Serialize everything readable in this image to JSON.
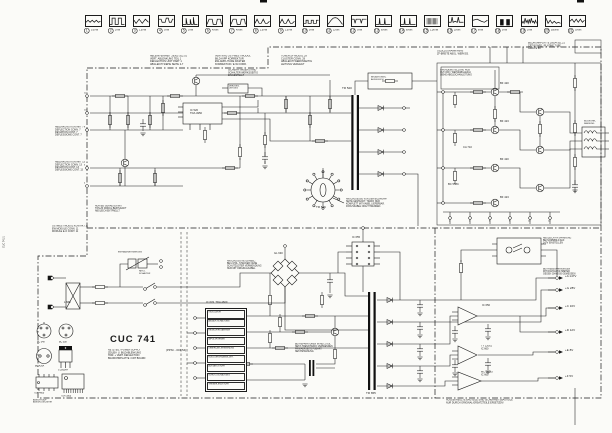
{
  "title_block": {
    "title": "CUC 741",
    "subtitle_lines": [
      "NETZTEIL / POWER SUPPLY",
      "ZEILEN- U. BILDABLENKUNG",
      "HOR. + VERT. DEFLECTION",
      "BILDROHRPLATTE / CRT BOARD"
    ],
    "part_number": "(PPNr - 001.54)"
  },
  "waveforms": [
    {
      "n": "1",
      "v": "0,3Vss",
      "shape": "sine-low"
    },
    {
      "n": "2",
      "v": "2Vss",
      "shape": "pulse2"
    },
    {
      "n": "3",
      "v": "1,5Vss",
      "shape": "sine-inv"
    },
    {
      "n": "4",
      "v": "3Vss",
      "shape": "mesa"
    },
    {
      "n": "5",
      "v": "2Vss",
      "shape": "spike-bar"
    },
    {
      "n": "6",
      "v": "45Vss",
      "shape": "trap"
    },
    {
      "n": "7",
      "v": "45Vss",
      "shape": "trap"
    },
    {
      "n": "8",
      "v": "2,5Vss",
      "shape": "hump2"
    },
    {
      "n": "9",
      "v": "2,5Vss",
      "shape": "hump2"
    },
    {
      "n": "10",
      "v": "5Vss",
      "shape": "pulse-low"
    },
    {
      "n": "11",
      "v": "12Vss",
      "shape": "parabola"
    },
    {
      "n": "12",
      "v": "3Vss",
      "shape": "checks"
    },
    {
      "n": "13",
      "v": "60Vss",
      "shape": "pulse-narrow"
    },
    {
      "n": "14",
      "v": "60Vss",
      "shape": "pulse-narrow"
    },
    {
      "n": "15",
      "v": "1,2kVss",
      "shape": "burst"
    },
    {
      "n": "16",
      "v": "25Vss",
      "shape": "spikes2"
    },
    {
      "n": "17",
      "v": "8Vss",
      "shape": "wave-diag"
    },
    {
      "n": "18",
      "v": "5Vss",
      "shape": "bars2"
    },
    {
      "n": "19",
      "v": "2Vss",
      "shape": "noise2"
    },
    {
      "n": "20",
      "v": "550Vss",
      "shape": "saw-decay"
    },
    {
      "n": "21",
      "v": "30Vss",
      "shape": "scribble"
    }
  ],
  "psu_ic": {
    "designator": "IC 633  TDA 4600",
    "functions": [
      "OSZILLATOR",
      "ANLAUF-SCHALTUNG",
      "REGELVERSTAERKER",
      "IMPULSFORMER",
      "UEBERLAST-ERKENNUNG",
      "NULLDURCHGANGS-DET.",
      "AUSTAST-STUFE",
      "SCHUTZ-SCHALTUNG",
      "TREIBER-ENDSTUFE"
    ]
  },
  "rails": [
    {
      "y": 278,
      "label": "+A 147V"
    },
    {
      "y": 290,
      "label": "+G 28V"
    },
    {
      "y": 308,
      "label": "+C 16V"
    },
    {
      "y": 332,
      "label": "+D 12V"
    },
    {
      "y": 352,
      "label": "+E 8V"
    },
    {
      "y": 378,
      "label": "+F 5V"
    }
  ],
  "labels": [
    {
      "x": 150,
      "y": 55,
      "t": "ABLENK-EINHEIT 29301-102.01\nVERT. ABLENKUNG TEIL 1\nDEFLECTION UNIT PART 1\nABGLEICH SIEHE SEITE 2-7",
      "s": 0.42
    },
    {
      "x": 215,
      "y": 55,
      "t": "VERTIKAL OST-WEST MODUL\nBILD-KIPP KORREKTUR\nEW-AMPLITUDE RASTER\nKORREKTUR / E-W CORR.",
      "s": 0.42
    },
    {
      "x": 281,
      "y": 55,
      "t": "TUNER-ZF MODUL 29\nCLUSTER CONN. 29\nABGLEICH WERKSSEITIG\nLEITUNG VERLEGT",
      "s": 0.42
    },
    {
      "x": 228,
      "y": 69,
      "t": "SICHERH.-WIDERSTAND\nSCHALTER WERKSSEITIG\nEINGESTELLT",
      "s": 0.4
    },
    {
      "x": 437,
      "y": 50,
      "t": "OSZILLOGRAMM FBAS\nZF-BREITE ABGL. WERKSS.",
      "s": 0.4
    },
    {
      "x": 528,
      "y": 42,
      "t": "BILDROHRPLATTE 29504-101.21\nCRT BOARD / PLATINE TUBE\nGRAU E 89",
      "s": 0.4
    },
    {
      "x": 440,
      "y": 69,
      "t": "GRUNDEINSTELLUNG RGB\nCUT-OFF / WEISSABGLEICH\nSIEHE ABGLEICHANLEITUNG",
      "s": 0.38
    },
    {
      "x": 55,
      "y": 126,
      "t": "ABLENKUNG KONTAKT 7\nDEFLECTION CONN. 7\nDEVIATION CONT. 7\nDEFLESSIONE CONT. 7",
      "s": 0.4
    },
    {
      "x": 55,
      "y": 161,
      "t": "ABLENKUNG KONTAKT 13\nDEFLECTION CONN. 13\nDEVIATION CONT. 13\nDEFLESSIONE CONT. 13",
      "s": 0.4
    },
    {
      "x": 52,
      "y": 225,
      "t": "OSTWEST MODUL KONTAKT 11\nEW MODULE CONN. 11\nMODULE E-O CONT. 11",
      "s": 0.4
    },
    {
      "x": 346,
      "y": 198,
      "t": "ANSCHLUESSE VON DER BILDROHR-\nSEITE GESTECKT. TRAFO NUR\nKOMPLETT MIT KABEL LIEFERBAR.\nFOKUSKABEL NICHT TRENNEN.",
      "s": 0.38
    },
    {
      "x": 95,
      "y": 205,
      "t": "NUR BEI GERAETEN MIT\nTON-ZF MODUL BESTUECKT\nABGLEICH ENTFAELLT",
      "s": 0.38
    },
    {
      "x": 227,
      "y": 260,
      "t": "ANSCHLUSS NETZKABEL:\nBEI 2-POL. STECKER OHNE\nSCHUTZLEITER VERWENDUNG\nNUR MIT ORIGINALKABEL",
      "s": 0.38
    },
    {
      "x": 295,
      "y": 343,
      "t": "BEI REPARATUREN IM NETZTEIL\nNETZ-TRENNTRAFO VERWENDEN\nPRIMAERSEITE FUEHRT\nNETZSPANNUNG",
      "s": 0.38
    },
    {
      "x": 446,
      "y": 399,
      "t": "AUSGEKREUZTE BAUTEILE SIND SICHERHEITSBAUTEILE\nNUR DURCH ORIGINAL-ERSATZTEILE ERSETZEN!",
      "s": 0.4
    },
    {
      "x": 543,
      "y": 237,
      "t": "ABGLEICH +A SPANNUNG\nBEI NORMBILD AUF\n147V EINSTELLEN",
      "s": 0.38
    },
    {
      "x": 543,
      "y": 268,
      "t": "BETRIEBSSPANNUNGEN\nMIT DIGITALVOLTMETER\nGEGEN CHASSIS GEMESSEN",
      "s": 0.38
    },
    {
      "x": 190,
      "y": 109,
      "t": "IC 520\nTDA 4950",
      "s": 0.45
    },
    {
      "x": 316,
      "y": 206,
      "t": "TR 526",
      "s": 0.5
    },
    {
      "x": 342,
      "y": 87,
      "t": "TR 520",
      "s": 0.5
    },
    {
      "x": 371,
      "y": 76,
      "t": "BELASTUNGS-\nAUSGLEICH",
      "s": 0.36
    },
    {
      "x": 500,
      "y": 82,
      "t": "BF 420",
      "s": 0.45
    },
    {
      "x": 500,
      "y": 120,
      "t": "BF 423",
      "s": 0.45
    },
    {
      "x": 500,
      "y": 158,
      "t": "BF 420",
      "s": 0.45
    },
    {
      "x": 500,
      "y": 196,
      "t": "BF 423",
      "s": 0.45
    },
    {
      "x": 463,
      "y": 146,
      "t": "CA 710",
      "s": 0.45
    },
    {
      "x": 448,
      "y": 183,
      "t": "BC 558C",
      "s": 0.45
    },
    {
      "x": 584,
      "y": 120,
      "t": "BILDROHR-\nFASSUNG",
      "s": 0.36
    },
    {
      "x": 206,
      "y": 301,
      "t": "IC 633  TDA 4600",
      "s": 0.45
    },
    {
      "x": 352,
      "y": 236,
      "t": "IC 655",
      "s": 0.45
    },
    {
      "x": 366,
      "y": 392,
      "t": "TR 655",
      "s": 0.5
    },
    {
      "x": 274,
      "y": 252,
      "t": "GL 630",
      "s": 0.45
    },
    {
      "x": 64,
      "y": 301,
      "t": "L 660",
      "s": 0.45
    },
    {
      "x": 139,
      "y": 270,
      "t": "NETZ-\nSCHALTER",
      "s": 0.36
    },
    {
      "x": 482,
      "y": 304,
      "t": "IC 650",
      "s": 0.45
    },
    {
      "x": 481,
      "y": 345,
      "t": "TY 12061\nIC 660",
      "s": 0.42
    },
    {
      "x": 481,
      "y": 371,
      "t": "MC 34063\nIC 665",
      "s": 0.42
    },
    {
      "x": 37,
      "y": 341,
      "t": "BC 548",
      "s": 0.38
    },
    {
      "x": 59,
      "y": 341,
      "t": "BC 558",
      "s": 0.38
    },
    {
      "x": 35,
      "y": 365,
      "t": "BU 426A",
      "s": 0.38
    },
    {
      "x": 58,
      "y": 369,
      "t": "S 2000AF",
      "s": 0.38
    },
    {
      "x": 34,
      "y": 392,
      "t": "TDA 4600",
      "s": 0.38
    },
    {
      "x": 61,
      "y": 395,
      "t": "TDA 3505",
      "s": 0.38
    },
    {
      "x": 33,
      "y": 399,
      "t": "ANSICHT AUF\nANSCHLUSS-SEITE",
      "s": 0.34
    },
    {
      "x": 118,
      "y": 251,
      "t": "ENTMAGNETISIERUNG",
      "s": 0.36
    },
    {
      "x": 229,
      "y": 85,
      "t": "VERZOEG.\nLEITUNG",
      "s": 0.34
    },
    {
      "x": 84,
      "y": 92,
      "t": "12",
      "s": 0.35
    },
    {
      "x": 84,
      "y": 109,
      "t": "10",
      "s": 0.35
    },
    {
      "x": 84,
      "y": 126,
      "t": "8",
      "s": 0.35
    },
    {
      "x": 84,
      "y": 164,
      "t": "6",
      "s": 0.35
    },
    {
      "x": 84,
      "y": 182,
      "t": "4",
      "s": 0.35
    },
    {
      "x": 449,
      "y": 220,
      "t": "2",
      "s": 0.35
    },
    {
      "x": 469,
      "y": 220,
      "t": "4",
      "s": 0.35
    },
    {
      "x": 489,
      "y": 220,
      "t": "6",
      "s": 0.35
    },
    {
      "x": 509,
      "y": 220,
      "t": "8",
      "s": 0.35
    },
    {
      "x": 528,
      "y": 220,
      "t": "10",
      "s": 0.35
    },
    {
      "x": 548,
      "y": 220,
      "t": "12",
      "s": 0.35
    },
    {
      "x": 3,
      "y": 248,
      "t": "CUC 741/1",
      "s": 0.4,
      "r": -90
    }
  ]
}
